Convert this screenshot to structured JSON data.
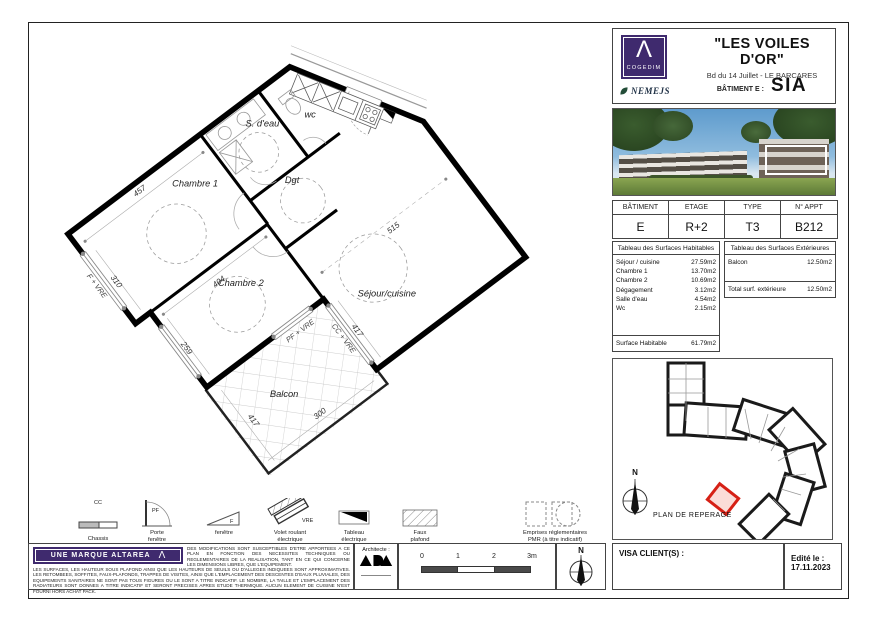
{
  "header": {
    "brand": "COGEDIM",
    "brand_glyph": "Λ",
    "partner": "NEMEJS",
    "title": "\"LES VOILES D'OR\"",
    "address": "Bd du 14 Juillet - LE BARCARES",
    "batiment_label": "BÂTIMENT E :",
    "batiment_code": "SIA"
  },
  "colors": {
    "brand_purple": "#3f2a6e",
    "highlight_red": "#d62015"
  },
  "info_table": {
    "headers": [
      "BÂTIMENT",
      "ETAGE",
      "TYPE",
      "N° APPT"
    ],
    "values": [
      "E",
      "R+2",
      "T3",
      "B212"
    ]
  },
  "surfaces_habitables": {
    "title": "Tableau des Surfaces Habitables",
    "rows": [
      {
        "name": "Séjour / cuisine",
        "value": "27.59m2"
      },
      {
        "name": "Chambre 1",
        "value": "13.70m2"
      },
      {
        "name": "Chambre 2",
        "value": "10.69m2"
      },
      {
        "name": "Dégagement",
        "value": "3.12m2"
      },
      {
        "name": "Salle d'eau",
        "value": "4.54m2"
      },
      {
        "name": "Wc",
        "value": "2.15m2"
      }
    ],
    "total": {
      "name": "Surface Habitable",
      "value": "61.79m2"
    }
  },
  "surfaces_exterieures": {
    "title": "Tableau des Surfaces Extérieures",
    "rows": [
      {
        "name": "Balcon",
        "value": "12.50m2"
      }
    ],
    "total": {
      "name": "Total surf. extérieure",
      "value": "12.50m2"
    }
  },
  "reperage": {
    "label": "PLAN DE REPERAGE",
    "north": "N"
  },
  "plan": {
    "room_labels": {
      "chambre1": "Chambre 1",
      "chambre2": "Chambre 2",
      "sdeau": "S. d'eau",
      "wc": "wc",
      "dgt": "Dgt",
      "sejour": "Séjour/cuisine",
      "balcon": "Balcon"
    },
    "dims": {
      "chambre1_w": "457",
      "chambre1_h": "310",
      "chambre2_w": "404",
      "chambre2_h": "259",
      "sejour_w": "515",
      "sejour_h": "417",
      "balcon_h": "417",
      "balcon_w": "300"
    },
    "window_labels": {
      "f_vre": "F + VRE",
      "pf_vre": "PF + VRE",
      "cc_vre": "CC + VRE"
    }
  },
  "legend": {
    "items": [
      {
        "symbol": "CC",
        "label1": "Chassis",
        "label2": "coulissant"
      },
      {
        "symbol": "PF",
        "label1": "Porte",
        "label2": "fenêtre"
      },
      {
        "symbol": "F",
        "label1": "fenêtre",
        "label2": ""
      },
      {
        "symbol": "VRE",
        "label1": "Volet roulant",
        "label2": "électrique"
      },
      {
        "symbol": "",
        "label1": "Tableau",
        "label2": "électrique"
      },
      {
        "symbol": "",
        "label1": "Faux",
        "label2": "plafond"
      },
      {
        "symbol": "",
        "label1": "Emprises réglementaires",
        "label2": "PMR (à titre indicatif)"
      }
    ]
  },
  "footer": {
    "brand_banner": "UNE MARQUE ALTAREA",
    "brand_glyph": "Λ",
    "disclaimer1": "DES MODIFICATIONS SONT SUSCEPTIBLES D'ETRE APPORTEES A CE PLAN EN FONCTION DES NECESSITES TECHNIQUES OU REGLEMENTAIRES DE LA REALISATION, TANT EN CE QUI CONCERNE LES DIMENSIONS LIBRES, QUE L'EQUIPEMENT.",
    "disclaimer2": "LES SURFACES, LES HAUTEUR SOUS PLAFOND AINSI QUE LES HAUTEURS DE SEUILS OU D'ALLEGES INDIQUEES SONT APPROXIMATIVES. LES RETOMBEES, SOFFITES, FAUX-PLAFONDS, TRAPPES DE VISITES, AINSI QUE L'EMPLACEMENT DES DESCENTES D'EAUX PLUVIALES, DES EQUIPEMENTS SANITAIRES NE SONT PAS TOUS FIGURES OU LE SONT A TITRE INDICATIF. LE NOMBRE, LA TAILLE ET L'EMPLACEMENT DES RADIATEURS SONT DONNES A TITRE INDICATIF ET SERONT PRECISES APRES ETUDE THERMIQUE. AUCUN ELEMENT DE CUISINE N'EST FOURNI HORS ACHAT PACK.",
    "architect_label": "Architecte :",
    "scale_ticks": [
      "0",
      "1",
      "2",
      "3m"
    ],
    "north": "N",
    "visa_label": "VISA CLIENT(S) :",
    "edited_label": "Edité le :",
    "edited_date": "17.11.2023"
  }
}
